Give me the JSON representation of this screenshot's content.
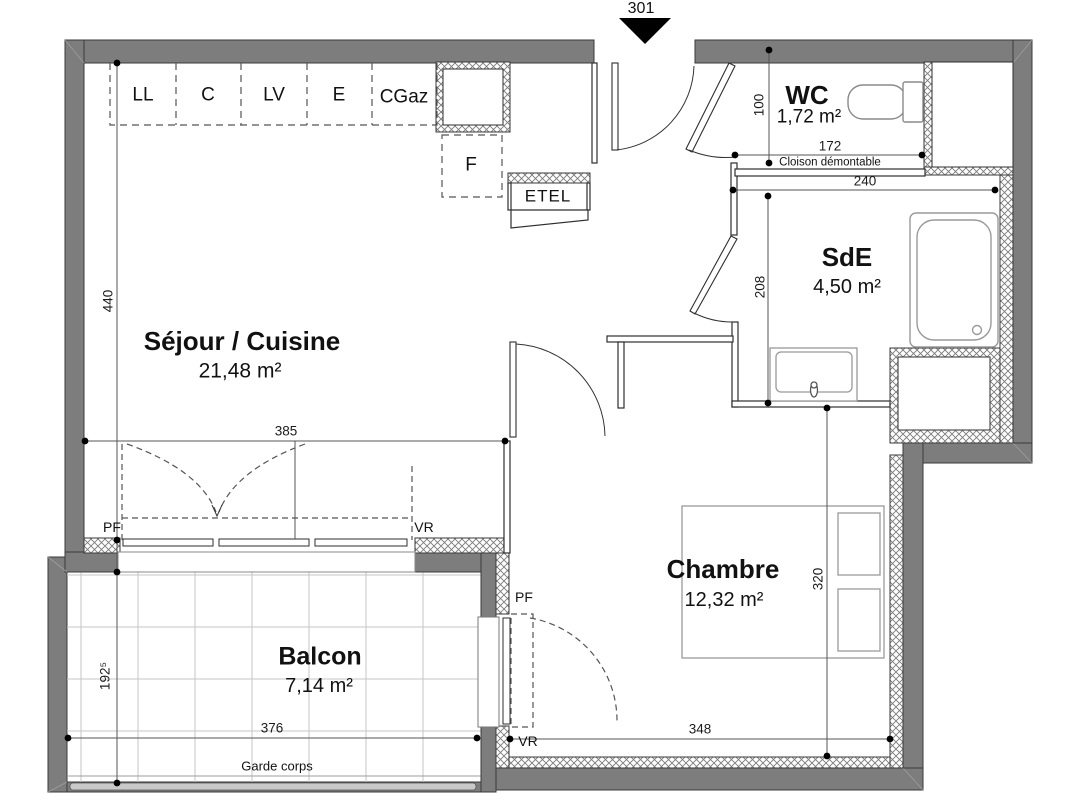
{
  "unit": {
    "number": "301"
  },
  "rooms": {
    "sejour": {
      "name": "Séjour / Cuisine",
      "area": "21,48 m²"
    },
    "wc": {
      "name": "WC",
      "area": "1,72 m²"
    },
    "sde": {
      "name": "SdE",
      "area": "4,50 m²"
    },
    "chambre": {
      "name": "Chambre",
      "area": "12,32 m²"
    },
    "balcon": {
      "name": "Balcon",
      "area": "7,14 m²"
    }
  },
  "kitchen": {
    "units": [
      "LL",
      "C",
      "LV",
      "E",
      "CGaz"
    ],
    "fridge": "F",
    "closet": "ETEL"
  },
  "annotations": {
    "cloison": "Cloison démontable",
    "garde_corps": "Garde corps",
    "pf": "PF",
    "vr": "VR"
  },
  "dimensions": {
    "sejour_h": "440",
    "sejour_w": "385",
    "wc_h": "100",
    "wc_w": "172",
    "sde_w": "240",
    "sde_h": "208",
    "chambre_h": "320",
    "chambre_w": "348",
    "balcon_w": "376",
    "balcon_d": "192⁵"
  },
  "colors": {
    "background": "#ffffff",
    "wall": "#7d7d7d",
    "wall_outline": "#3a3a3a",
    "hatch_line": "#7a7a7a",
    "partition_outline": "#2e2e2e",
    "dim_line": "#555555",
    "fixture_outline": "#949494",
    "tile_line": "#c6c6c6",
    "text": "#111111"
  }
}
